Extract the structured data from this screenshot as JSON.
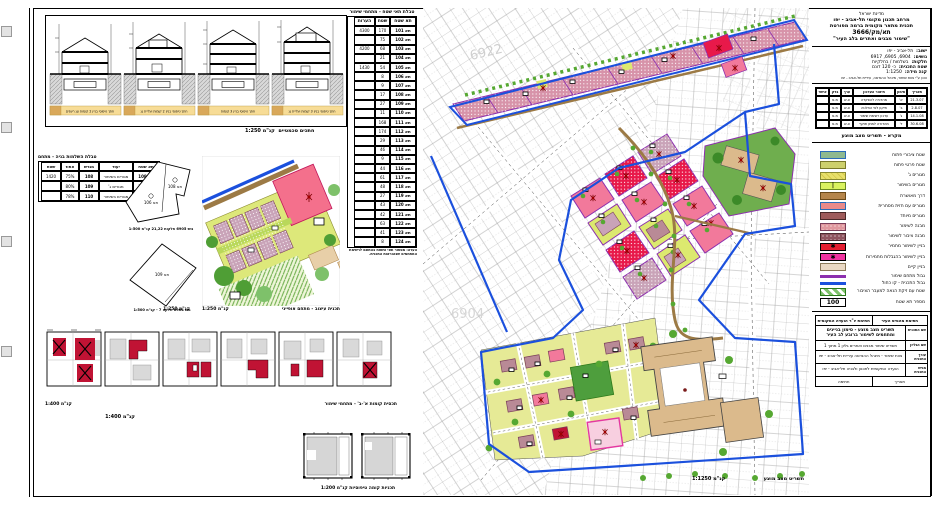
{
  "map": {
    "caption": "תשריט מצב מוצע",
    "scale": "קנ\"מ 1:1250",
    "block_numbers": [
      "6922",
      "6904"
    ]
  },
  "sections_panel": {
    "sections": [
      {
        "label": "חתך טיפוסי בניין 2 קומות וגג רעפים"
      },
      {
        "label": "חתך טיפוסי בניין 2 קומות ועליית גג"
      },
      {
        "label": "חתך טיפוסי בניין 3 קומות"
      },
      {
        "label": "חתך טיפוסי בניין 3 קומות ועליית גג"
      }
    ],
    "caption": "חתכים סכמטיים",
    "scale": "קנ\"מ 1:250"
  },
  "tree_table": {
    "title": "טבלת תאי שטח - מתחמי שימור",
    "columns": [
      "תא שטח",
      "שטח",
      "הערות"
    ],
    "rows": [
      [
        "4300",
        "170",
        "תא 101"
      ],
      [
        "",
        "75",
        "תא 102"
      ],
      [
        "4200",
        "68",
        "תא 103"
      ],
      [
        "",
        "21",
        "תא 104"
      ],
      [
        "1430",
        "54",
        "תא 105"
      ],
      [
        "",
        "8",
        "תא 106"
      ],
      [
        "",
        "9",
        "תא 107"
      ],
      [
        "",
        "17",
        "תא 108"
      ],
      [
        "",
        "27",
        "תא 109"
      ],
      [
        "",
        "11",
        "תא 110"
      ],
      [
        "",
        "168",
        "תא 111"
      ],
      [
        "",
        "174",
        "תא 112"
      ],
      [
        "",
        "29",
        "תא 113"
      ],
      [
        "",
        "46",
        "תא 114"
      ],
      [
        "",
        "9",
        "תא 115"
      ],
      [
        "",
        "44",
        "תא 116"
      ],
      [
        "",
        "61",
        "תא 117"
      ],
      [
        "",
        "48",
        "תא 118"
      ],
      [
        "",
        "27",
        "תא 119"
      ],
      [
        "",
        "43",
        "תא 120"
      ],
      [
        "",
        "42",
        "תא 121"
      ],
      [
        "",
        "63",
        "תא 122"
      ],
      [
        "",
        "41",
        "תא 123"
      ],
      [
        "",
        "8",
        "תא 124"
      ]
    ],
    "footnote": "הערה: מספור תאי השטח בהתאם לרשימת המתחמים שבהוראות התכנית."
  },
  "mini_table": {
    "title": "טבלת השלמות בניה - מתחם",
    "columns": [
      "תא שטח",
      "יעוד",
      "מגרש",
      "אחוז",
      "שטח"
    ],
    "rows": [
      [
        "תא 108",
        "מגורים בשימור",
        "108",
        "75%",
        "1420"
      ],
      [
        "תא 109",
        "מגורים ג'",
        "109",
        "80%",
        ""
      ],
      [
        "תא 110",
        "מגורים בשימור",
        "110",
        "78%",
        ""
      ]
    ]
  },
  "parcels": {
    "upper_label_1": "תא 106",
    "upper_label_2": "תא 108",
    "lower_label": "תא 109",
    "upper_caption": "גוש 6905 חלקות 21,22  קנ\"מ 1:500",
    "lower_caption": "גוש 6904 חלקה 7 - קנ\"מ 1:500"
  },
  "detail_plan": {
    "caption": "תכנית עיצוב - מתחם אופייני",
    "scale": "קנ\"מ 1:250"
  },
  "coverage_panel": {
    "caption": "תכסית קומות א'-ב' - מתחמי שימור",
    "scale": "קנ\"מ 1:400"
  },
  "floorplans_panel": {
    "caption": "תכניות קומה טיפוסיות  קנ\"מ 1:200"
  },
  "title_block": {
    "line0": "מדינת ישראל",
    "line1": "מרחב תכנון מקומי תל-אביב - יפו",
    "line2": "תכנית מתאר מקומית ברמה מפורטת",
    "line3": "תא/מק/3666",
    "line4": "\"שימור מבנים ואתרים בלב העיר\""
  },
  "info_block": {
    "rows": [
      {
        "label": "ישוב:",
        "value": "תל-אביב - יפו"
      },
      {
        "label": "גושים:",
        "value": "6904, 6905, 6917"
      },
      {
        "label": "חלקות:",
        "value": "בשלמות / בחלקיות"
      },
      {
        "label": "שטח התכנית:",
        "value": "כ- 120 דונם"
      },
      {
        "label": "קנה מידה:",
        "value": "1:1250"
      }
    ],
    "note": "הוכן ע\"י צוות שימור, מינהל ההנדסה, עיריית תל-אביב - יפו"
  },
  "sheet_table": {
    "columns": [
      "תאריך",
      "סימון",
      "תיאור העדכון",
      "ערך",
      "בדק",
      "אישר"
    ],
    "rows": [
      [
        "21.3.07",
        "א'",
        "מהדורה להפקדה",
        "צ.ש",
        "מ.פ",
        ""
      ],
      [
        "2.8.07",
        "ב'",
        "תיקון לפי החלטה",
        "צ.ש",
        "מ.פ",
        ""
      ],
      [
        "14.1.08",
        "ג'",
        "עדכון רשימת שימור",
        "צ.ש",
        "מ.פ",
        ""
      ],
      [
        "30.6.08",
        "ד'",
        "מהדורה למתן תוקף",
        "צ.ש",
        "מ.פ",
        ""
      ]
    ]
  },
  "legend": {
    "title": "מקרא - תשריט מצב מוצע",
    "items": [
      {
        "label": "שטח ציבורי פתוח",
        "bg": "#8fb98f",
        "border": "#2b6cb8",
        "glyph": "",
        "h": "8px"
      },
      {
        "label": "שטח פרטי פתוח",
        "bg": "#cdd06c",
        "border": "#7a7a2a",
        "glyph": "",
        "h": "8px"
      },
      {
        "label": "מגורים ג'",
        "bg": "repeating-linear-gradient(45deg,#e8e06a 0 3px,#d5c94a 3px 4px)",
        "border": "#8a8a30",
        "glyph": "",
        "h": "8px"
      },
      {
        "label": "מגורים בשימור",
        "bg": "#d9f25f",
        "border": "#6a8a20",
        "glyph": "|",
        "h": "8px"
      },
      {
        "label": "דרך מאושרת",
        "bg": "#b5854b",
        "border": "#6a4a1a",
        "glyph": "",
        "h": "8px"
      },
      {
        "label": "מגורים עם חזית מסחרית",
        "bg": "#e98a8a",
        "border": "#2b6cb8",
        "glyph": "",
        "h": "8px"
      },
      {
        "label": "מגורים מיוחד",
        "bg": "#9e5b5b",
        "border": "#4a2a2a",
        "glyph": "",
        "h": "8px"
      },
      {
        "label": "מבנה לשימור",
        "bg": "radial-gradient(#ffffff 22%, rgba(0,0,0,0) 23%) 0 0 / 4px 4px repeat, #e0989e",
        "border": "#7a3f5a",
        "glyph": "",
        "h": "8px"
      },
      {
        "label": "מבנה ציבור לשימור",
        "bg": "radial-gradient(#ffffff 22%, rgba(0,0,0,0) 23%) 0 0 / 4px 4px repeat, #8f5560",
        "border": "#4a2a30",
        "glyph": "",
        "h": "8px"
      },
      {
        "label": "בניין לשימור מחמיר",
        "bg": "#e41d30",
        "border": "#000000",
        "glyph": "✱",
        "h": "8px"
      },
      {
        "label": "בניין לשימור בהגבלות מחמירות",
        "bg": "#f032a0",
        "border": "#000000",
        "glyph": "✱",
        "h": "8px"
      },
      {
        "label": "בניין קיים",
        "bg": "#ead9c4",
        "border": "#8a7a5a",
        "glyph": "",
        "h": "8px"
      },
      {
        "label": "גבול מתחם שימור",
        "bg": "#8c2fae",
        "border": "#8c2fae",
        "glyph": "",
        "h": "3px"
      },
      {
        "label": "גבול התכנית - קו כחול",
        "bg": "#1b50dd",
        "border": "#1b50dd",
        "glyph": "",
        "h": "3px"
      },
      {
        "label": "שטח עם זיקת הנאה למעבר הציבור",
        "bg": "repeating-linear-gradient(45deg,#7ec16a 0 3px,#ffffff 3px 6px)",
        "border": "#2a7a1a",
        "glyph": "",
        "h": "8px"
      },
      {
        "label": "מספר תא שטח",
        "bg": "#ffffff",
        "border": "#000000",
        "glyph": "100",
        "h": "9px"
      }
    ]
  },
  "approval_block": {
    "header": [
      "חתימת מהנדס העיר",
      "חתימת יו\"ר הועדה המקומית"
    ],
    "rows": [
      {
        "label": "שם התכנית",
        "content": "תשריט מצב מוצע - סימון בניינים ומתחמים לשימור ברובע לב העיר",
        "bold": "b"
      },
      {
        "label": "שם הגליון",
        "content": "תשריט שימור מבנים ואתרים  גליון 1 מתוך 1",
        "bold": ""
      },
      {
        "label": "עורך התכנית",
        "content": "צוות שימור - מינהל ההנדסה עיריית תל-אביב - יפו",
        "bold": ""
      },
      {
        "label": "מגיש התכנית",
        "content": "הועדה המקומית לתכנון ולבניה תל-אביב - יפו",
        "bold": ""
      }
    ],
    "footer": [
      "תאריך",
      "חתימה"
    ]
  }
}
